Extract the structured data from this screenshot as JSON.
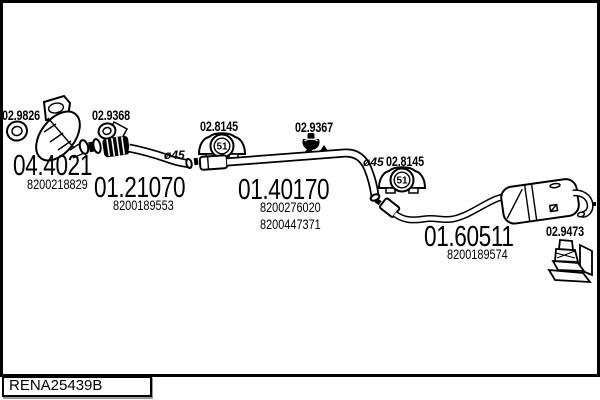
{
  "colors": {
    "ink": "#000000",
    "paper": "#ffffff"
  },
  "catalog_ref": "RENA25439B",
  "parts": {
    "front_gasket": {
      "code": "02.9826"
    },
    "catalyst": {
      "code": "04.4021",
      "oe": "8200218829"
    },
    "mid_gasket": {
      "code": "02.9368"
    },
    "front_pipe": {
      "code": "01.21070",
      "oe": "8200189553",
      "diameter": "ø45"
    },
    "hanger_front": {
      "code": "02.8145",
      "marking": "51"
    },
    "clamp": {
      "code": "02.9367"
    },
    "centre_pipe": {
      "code": "01.40170",
      "oe": [
        "8200276020",
        "8200447371"
      ],
      "diameter": "ø45"
    },
    "hanger_rear": {
      "code": "02.8145",
      "marking": "51"
    },
    "rear_silencer": {
      "code": "01.60511",
      "oe": "8200189574"
    },
    "mount_bracket": {
      "code": "02.9473"
    }
  }
}
